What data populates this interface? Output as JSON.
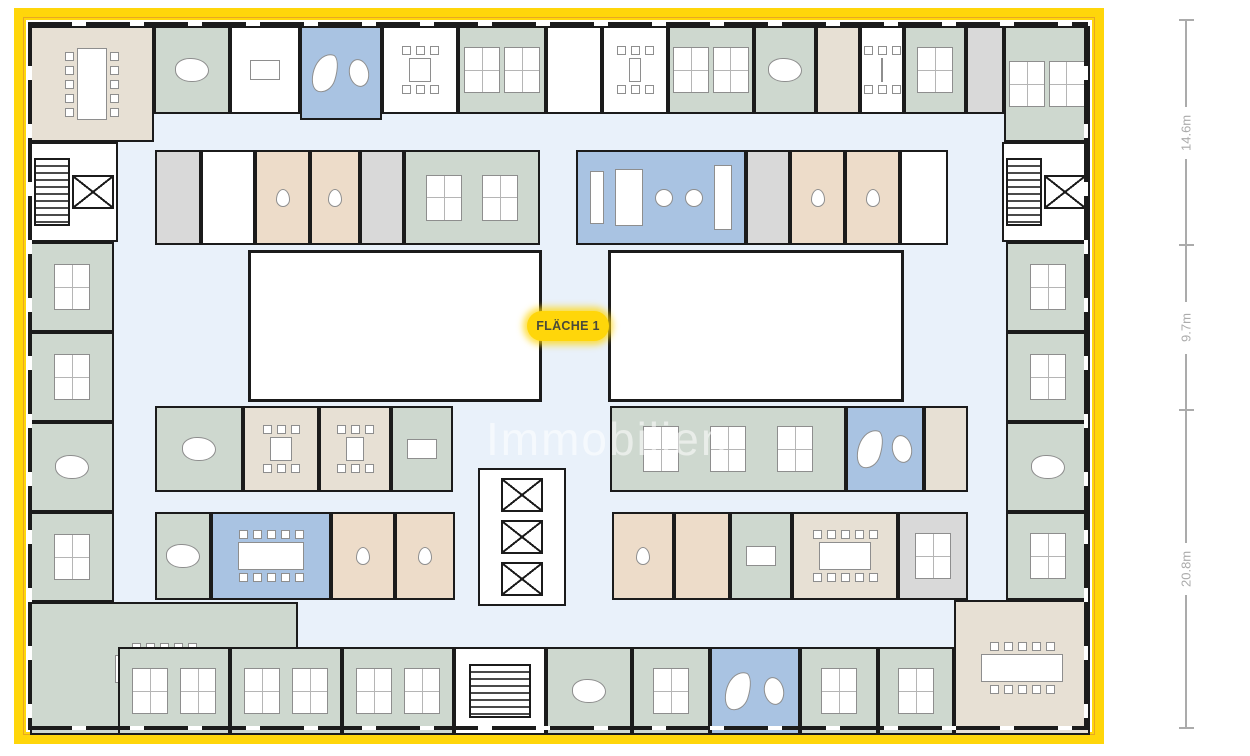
{
  "badge": {
    "label": "FLÄCHE 1",
    "background": "#FFD60A",
    "text_color": "#4A4A3A"
  },
  "watermark": {
    "text": "Immobilien",
    "color": "#FFFFFF",
    "opacity": 0.55
  },
  "dimension_ruler": {
    "color": "#ABABAB",
    "segments": [
      {
        "label": "14.6m",
        "from": 20,
        "to": 245
      },
      {
        "label": "9.7m",
        "from": 245,
        "to": 410
      },
      {
        "label": "20.8m",
        "from": 410,
        "to": 728
      }
    ]
  },
  "palette": {
    "frame_yellow": "#FFD60A",
    "frame_accent": "#E8A723",
    "wall": "#1b1b1b",
    "green": "#CED8CF",
    "beige": "#E7E0D4",
    "tan": "#EDDCC9",
    "blue": "#A9C3E2",
    "white": "#FFFFFF",
    "gray": "#D9D9D9",
    "corridor": "#E9F1FA",
    "furniture_outline": "#8e8e8e",
    "dimension_gray": "#ABABAB"
  },
  "plan": {
    "corridor": {
      "x": 112,
      "y": 112,
      "w": 898,
      "h": 537
    },
    "rooms_columns": [
      "x",
      "y",
      "w",
      "h",
      "fill",
      "furniture",
      "name"
    ],
    "rooms": [
      [
        30,
        26,
        124,
        116,
        "beige",
        "conf-v",
        "conference-room-top-left"
      ],
      [
        154,
        26,
        76,
        88,
        "green",
        "exec",
        "office-exec"
      ],
      [
        230,
        26,
        70,
        88,
        "white",
        "deskone",
        "office-small"
      ],
      [
        300,
        26,
        82,
        94,
        "blue",
        "blobs",
        "lounge-top"
      ],
      [
        382,
        26,
        76,
        88,
        "white",
        "table",
        "meeting-room"
      ],
      [
        458,
        26,
        88,
        88,
        "green",
        "desks2",
        "open-office"
      ],
      [
        546,
        26,
        56,
        88,
        "white",
        "none",
        "room"
      ],
      [
        602,
        26,
        66,
        88,
        "white",
        "table",
        "meeting-room"
      ],
      [
        668,
        26,
        86,
        88,
        "green",
        "desks2",
        "open-office"
      ],
      [
        754,
        26,
        62,
        88,
        "green",
        "exec",
        "office-exec"
      ],
      [
        816,
        26,
        44,
        88,
        "beige",
        "none",
        "room"
      ],
      [
        860,
        26,
        44,
        88,
        "white",
        "table",
        "meeting-room"
      ],
      [
        904,
        26,
        62,
        88,
        "green",
        "desks1",
        "open-office"
      ],
      [
        966,
        26,
        38,
        88,
        "gray",
        "none",
        "utility-room"
      ],
      [
        1004,
        26,
        86,
        116,
        "green",
        "desks2",
        "open-office-top-right"
      ],
      [
        30,
        142,
        88,
        100,
        "white",
        "core",
        "stairwell-elevator-left"
      ],
      [
        30,
        242,
        84,
        90,
        "green",
        "desks1",
        "open-office"
      ],
      [
        30,
        332,
        84,
        90,
        "green",
        "desks1",
        "open-office"
      ],
      [
        30,
        422,
        84,
        90,
        "green",
        "exec",
        "office-exec"
      ],
      [
        30,
        512,
        84,
        90,
        "green",
        "desks1",
        "open-office"
      ],
      [
        30,
        602,
        268,
        133,
        "green",
        "conf-h",
        "meeting-room-bottom-left"
      ],
      [
        1002,
        142,
        88,
        100,
        "white",
        "core",
        "stairwell-elevator-right"
      ],
      [
        1006,
        242,
        84,
        90,
        "green",
        "desks1",
        "open-office"
      ],
      [
        1006,
        332,
        84,
        90,
        "green",
        "desks1",
        "open-office"
      ],
      [
        1006,
        422,
        84,
        90,
        "green",
        "exec",
        "office-exec"
      ],
      [
        1006,
        512,
        84,
        88,
        "green",
        "desks1",
        "open-office"
      ],
      [
        954,
        600,
        136,
        135,
        "beige",
        "conf-h",
        "conference-room-bottom-right"
      ],
      [
        118,
        647,
        112,
        88,
        "green",
        "desks2",
        "open-office"
      ],
      [
        230,
        647,
        112,
        88,
        "green",
        "desks2",
        "open-office"
      ],
      [
        342,
        647,
        112,
        88,
        "green",
        "desks2",
        "open-office"
      ],
      [
        454,
        647,
        92,
        88,
        "white",
        "stairs",
        "stairwell-bottom"
      ],
      [
        546,
        647,
        86,
        88,
        "green",
        "exec",
        "office-exec"
      ],
      [
        632,
        647,
        78,
        88,
        "green",
        "desks1",
        "open-office"
      ],
      [
        710,
        647,
        90,
        88,
        "blue",
        "blobs",
        "lounge-bottom"
      ],
      [
        800,
        647,
        78,
        88,
        "green",
        "desks1",
        "open-office"
      ],
      [
        878,
        647,
        76,
        88,
        "green",
        "desks1",
        "open-office"
      ],
      [
        155,
        150,
        46,
        95,
        "gray",
        "none",
        "utility-room"
      ],
      [
        201,
        150,
        54,
        95,
        "white",
        "none",
        "room"
      ],
      [
        255,
        150,
        55,
        95,
        "tan",
        "wc",
        "wc"
      ],
      [
        310,
        150,
        50,
        95,
        "tan",
        "wc",
        "wc"
      ],
      [
        360,
        150,
        44,
        95,
        "gray",
        "none",
        "utility-room"
      ],
      [
        404,
        150,
        136,
        95,
        "green",
        "desks2",
        "open-office"
      ],
      [
        576,
        150,
        170,
        95,
        "blue",
        "cafe",
        "cafeteria"
      ],
      [
        746,
        150,
        44,
        95,
        "gray",
        "none",
        "utility-room"
      ],
      [
        790,
        150,
        55,
        95,
        "tan",
        "wc",
        "wc"
      ],
      [
        845,
        150,
        55,
        95,
        "tan",
        "wc",
        "wc"
      ],
      [
        900,
        150,
        48,
        95,
        "white",
        "none",
        "room"
      ],
      [
        248,
        250,
        294,
        152,
        "white",
        "courtyard",
        "courtyard-left"
      ],
      [
        608,
        250,
        296,
        152,
        "white",
        "courtyard",
        "courtyard-right"
      ],
      [
        155,
        406,
        88,
        86,
        "green",
        "exec",
        "office-exec"
      ],
      [
        243,
        406,
        76,
        86,
        "beige",
        "table",
        "meeting-room"
      ],
      [
        319,
        406,
        72,
        86,
        "beige",
        "table",
        "meeting-room"
      ],
      [
        391,
        406,
        62,
        86,
        "green",
        "deskone",
        "office-small"
      ],
      [
        610,
        406,
        236,
        86,
        "green",
        "desks3",
        "open-office"
      ],
      [
        846,
        406,
        78,
        86,
        "blue",
        "blobs",
        "lounge-mid-right"
      ],
      [
        924,
        406,
        44,
        86,
        "beige",
        "none",
        "room"
      ],
      [
        478,
        468,
        88,
        138,
        "white",
        "elevators",
        "elevator-core"
      ],
      [
        155,
        512,
        56,
        88,
        "green",
        "exec",
        "office-exec"
      ],
      [
        211,
        512,
        120,
        88,
        "blue",
        "conf-h",
        "meeting-room-blue"
      ],
      [
        331,
        512,
        64,
        88,
        "tan",
        "wc",
        "wc"
      ],
      [
        395,
        512,
        60,
        88,
        "tan",
        "wc",
        "wc"
      ],
      [
        612,
        512,
        62,
        88,
        "tan",
        "wc",
        "wc"
      ],
      [
        674,
        512,
        56,
        88,
        "tan",
        "none",
        "room"
      ],
      [
        730,
        512,
        62,
        88,
        "green",
        "deskone",
        "office-small"
      ],
      [
        792,
        512,
        106,
        88,
        "beige",
        "conf-h",
        "conference-room"
      ],
      [
        898,
        512,
        70,
        88,
        "gray",
        "desks1",
        "utility-office"
      ]
    ]
  }
}
